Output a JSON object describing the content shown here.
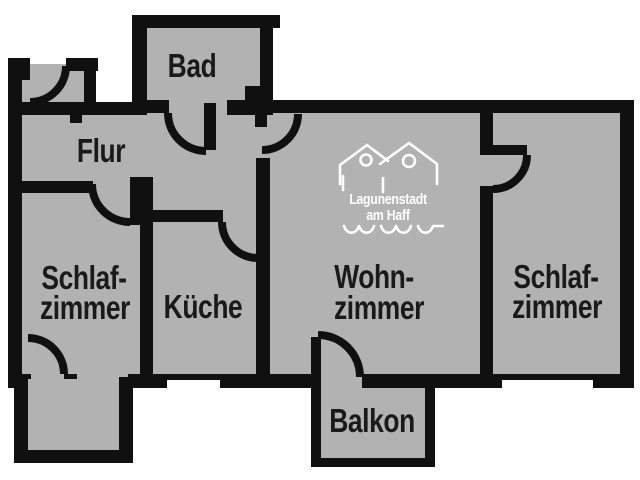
{
  "colors": {
    "background": "#ffffff",
    "floor": "#b2b2b2",
    "wall": "#101010",
    "label": "#1a1a1a",
    "logo": "#ffffff"
  },
  "rooms": {
    "bad": {
      "label": "Bad"
    },
    "flur": {
      "label": "Flur"
    },
    "schlafzimmer_links": {
      "line1": "Schlaf-",
      "line2": "zimmer"
    },
    "kueche": {
      "label": "Küche"
    },
    "wohnzimmer": {
      "line1": "Wohn-",
      "line2": "zimmer"
    },
    "schlafzimmer_rechts": {
      "line1": "Schlaf-",
      "line2": "zimmer"
    },
    "balkon": {
      "label": "Balkon"
    }
  },
  "logo": {
    "line1": "Lagunenstadt",
    "line2": "am Haff"
  }
}
